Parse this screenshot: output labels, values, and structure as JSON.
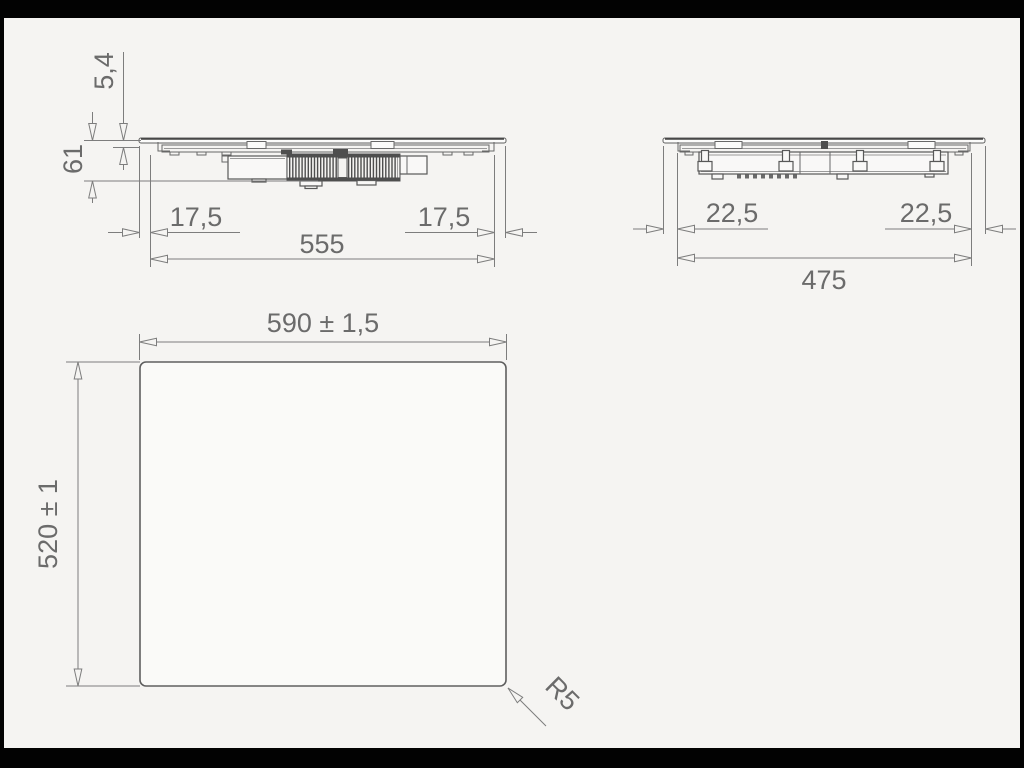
{
  "title": "cooktop-installation-drawing",
  "colors": {
    "background": "#f5f4f2",
    "line": "#7d7d7d",
    "drawing": "#585858",
    "text": "#6b6b6b",
    "letterbox": "#020202"
  },
  "views": {
    "side": {
      "label": "side-section-view",
      "dims": {
        "plate_thickness": "5,4",
        "height": "61",
        "overhang_left": "17,5",
        "overhang_right": "17,5",
        "width": "555"
      }
    },
    "end": {
      "label": "end-section-view",
      "dims": {
        "overhang_left": "22,5",
        "overhang_right": "22,5",
        "depth": "475"
      }
    },
    "top": {
      "label": "top-cutout-view",
      "dims": {
        "width": "590 ± 1,5",
        "depth": "520 ± 1",
        "corner_radius": "R5"
      }
    }
  }
}
